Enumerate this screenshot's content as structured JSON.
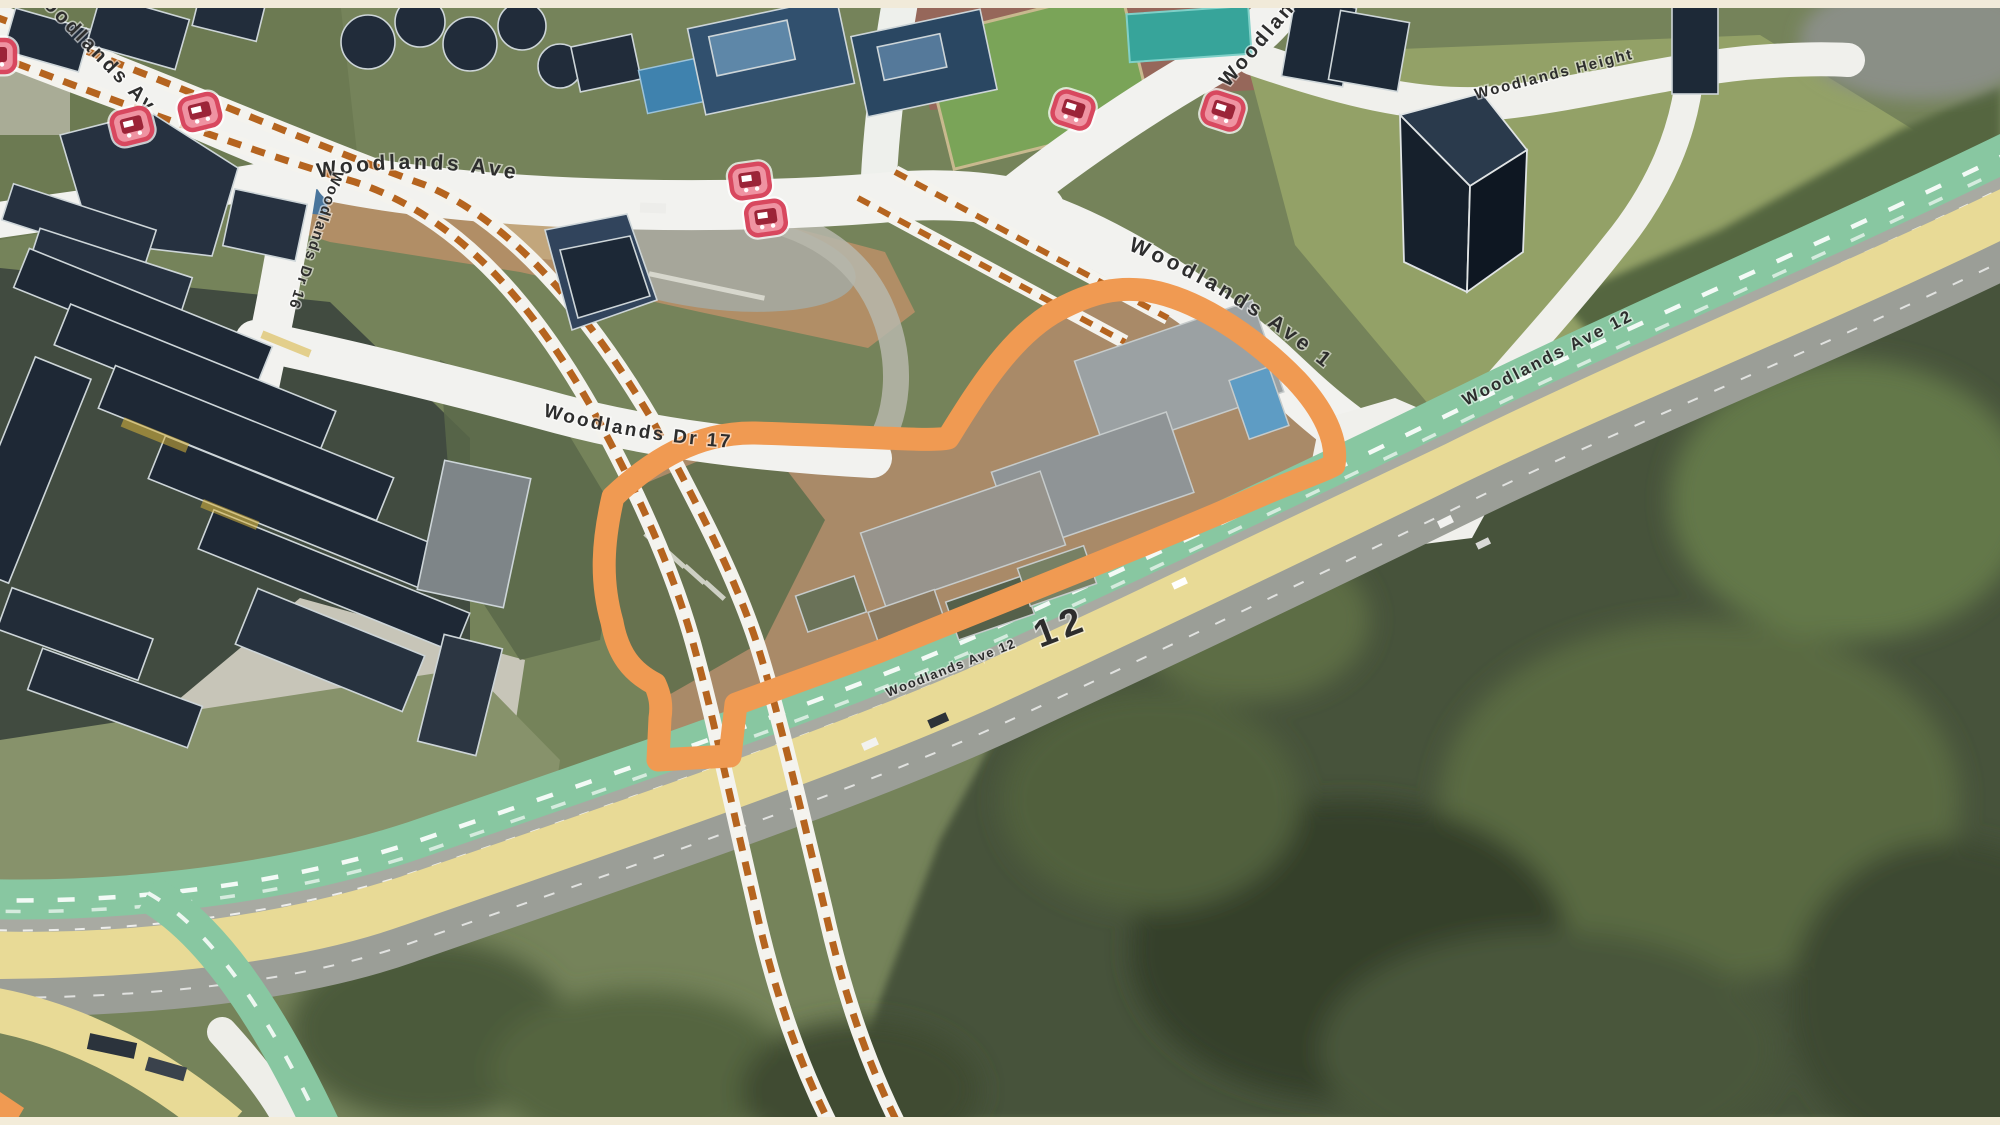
{
  "map": {
    "view": "3d-aerial",
    "frame_color": "#F1EAD9",
    "road_labels": {
      "ave1_nw": "Woodlands Ave 1",
      "ave1_mid": "Woodlands Ave 1",
      "ave1_top": "Woodlands Ave 1",
      "ave1_curve": "Woodlands Ave 1",
      "dr16": "Woodlands Dr 16",
      "dr17": "Woodlands Dr 17",
      "height": "Woodlands Height",
      "ave12_main": "Woodlands Ave 12",
      "ave12_small": "Woodlands Ave 12",
      "ave12_big": "12"
    },
    "highlight_colors": {
      "site_outline_orange": "#F09A52",
      "route_green": "#88C7A1",
      "road_yellow": "#E8DA96",
      "rail_dash_orange": "#B5641F",
      "bus_stop_pink": "#E0556E"
    },
    "bus_stops": [
      {
        "x": -4,
        "y": 56,
        "r": 0
      },
      {
        "x": 132,
        "y": 126,
        "r": -14
      },
      {
        "x": 200,
        "y": 112,
        "r": -14
      },
      {
        "x": 750,
        "y": 181,
        "r": -8
      },
      {
        "x": 766,
        "y": 218,
        "r": -8
      },
      {
        "x": 1073,
        "y": 110,
        "r": 18
      },
      {
        "x": 1223,
        "y": 111,
        "r": 18
      }
    ]
  }
}
